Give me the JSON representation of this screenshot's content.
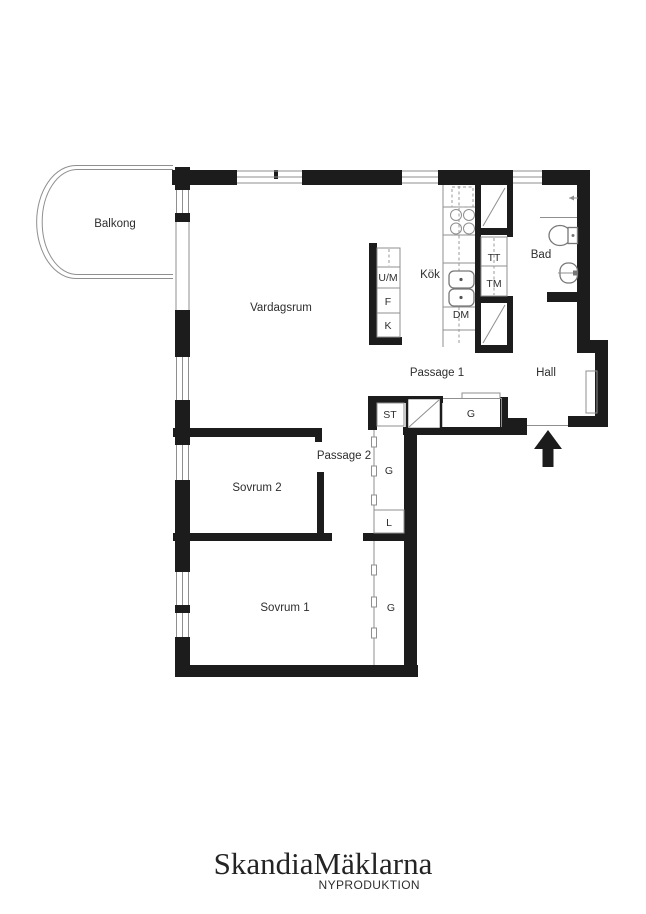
{
  "plan": {
    "rooms": {
      "balkong": "Balkong",
      "vardagsrum": "Vardagsrum",
      "kok": "Kök",
      "bad": "Bad",
      "hall": "Hall",
      "passage1": "Passage 1",
      "passage2": "Passage 2",
      "sovrum2": "Sovrum 2",
      "sovrum1": "Sovrum 1"
    },
    "appliances": {
      "um": "U/M",
      "f": "F",
      "k": "K",
      "dm": "DM",
      "tt": "TT",
      "tm": "TM"
    },
    "storage": {
      "st": "ST",
      "g_passage1": "G",
      "g_passage2": "G",
      "l": "L",
      "g_sovrum1": "G"
    },
    "colors": {
      "wall": "#1c1c1c",
      "thin_line": "#8f8f8f",
      "text": "#2e2e2e"
    }
  },
  "branding": {
    "name": "SkandiaMäklarna",
    "tagline": "NYPRODUKTION"
  }
}
